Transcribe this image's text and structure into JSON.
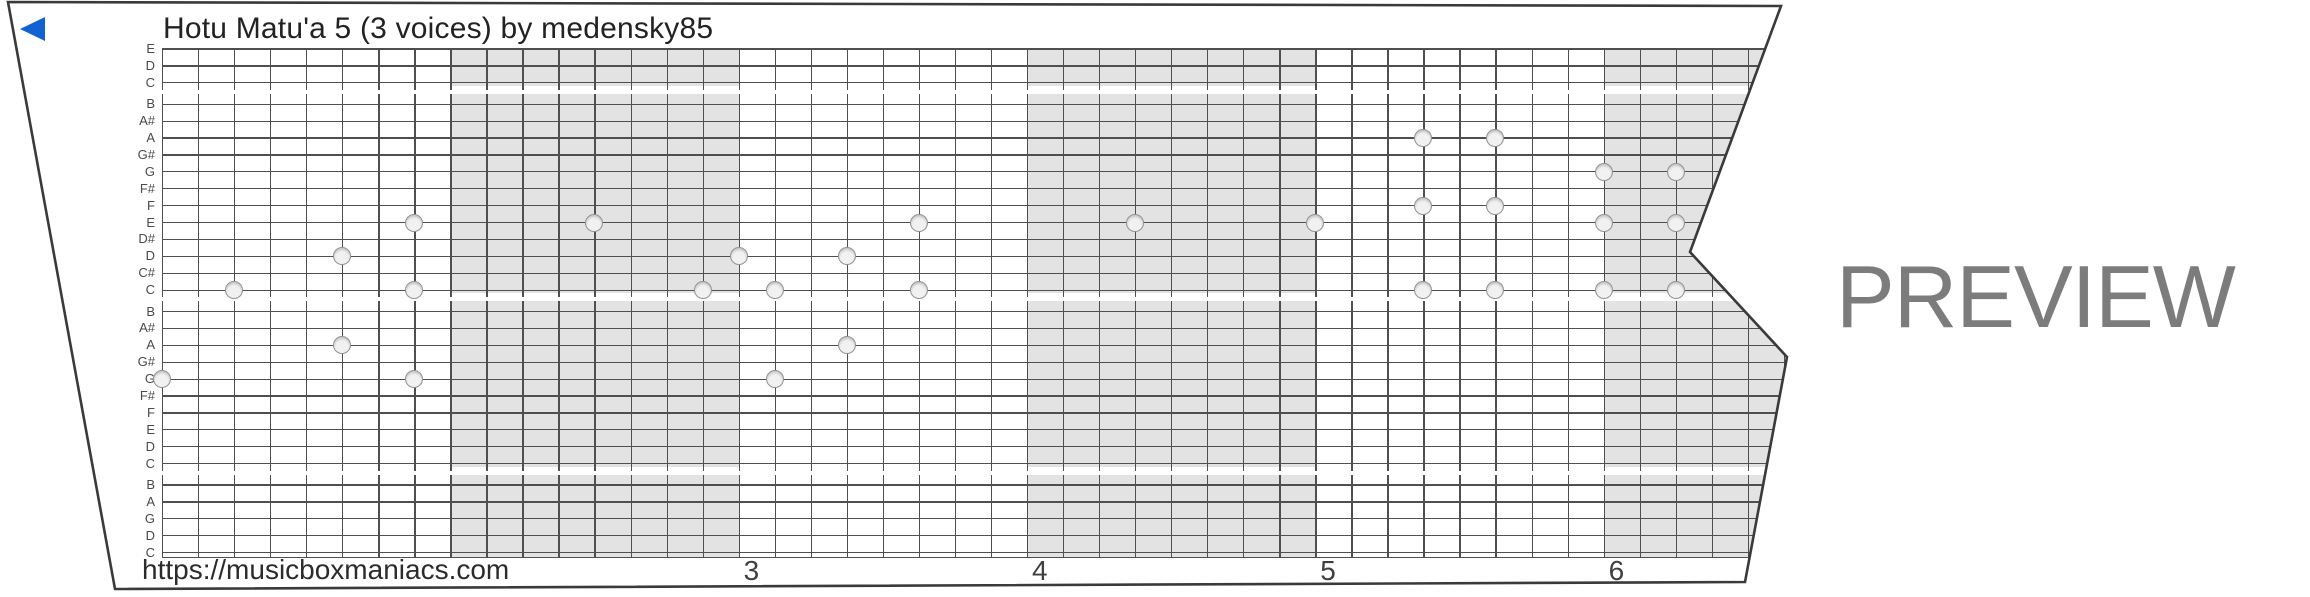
{
  "title": "Hotu Matu'a 5 (3 voices) by medensky85",
  "watermark": "PREVIEW",
  "footer": {
    "url": "https://musicboxmaniacs.com"
  },
  "colors": {
    "play_accent": "#1263d1",
    "paper_edge": "#3a3a3a",
    "grid_line": "#4f4f4f",
    "measure_shade": "#e3e3e3",
    "hole_fill": "#f1f1f1",
    "hole_stroke": "#939393",
    "watermark_gray": "#7c7c7c"
  },
  "strip": {
    "row_labels": [
      "E",
      "D",
      "C",
      "B",
      "A#",
      "A",
      "G#",
      "G",
      "F#",
      "F",
      "E",
      "D#",
      "D",
      "C#",
      "C",
      "B",
      "A#",
      "A",
      "G#",
      "G",
      "F#",
      "F",
      "E",
      "D",
      "C",
      "B",
      "A",
      "G",
      "D",
      "C"
    ],
    "octave_gap_after_rows": [
      3,
      15,
      25
    ],
    "steps_per_measure": 8,
    "visible_steps": 48,
    "measure_numbers": [
      {
        "label": "3",
        "barline_step": 16
      },
      {
        "label": "4",
        "barline_step": 24
      },
      {
        "label": "5",
        "barline_step": 32
      },
      {
        "label": "6",
        "barline_step": 40
      }
    ],
    "shaded_measure_step_ranges": [
      [
        8,
        16
      ],
      [
        24,
        32
      ],
      [
        40,
        48
      ]
    ],
    "notes": [
      {
        "pitch": "G4",
        "row": 20,
        "step": 0
      },
      {
        "pitch": "C5",
        "row": 15,
        "step": 2
      },
      {
        "pitch": "D5",
        "row": 13,
        "step": 5
      },
      {
        "pitch": "A4",
        "row": 18,
        "step": 5
      },
      {
        "pitch": "E5",
        "row": 11,
        "step": 7
      },
      {
        "pitch": "C5",
        "row": 15,
        "step": 7
      },
      {
        "pitch": "G4",
        "row": 20,
        "step": 7
      },
      {
        "pitch": "E5",
        "row": 11,
        "step": 12
      },
      {
        "pitch": "C5",
        "row": 15,
        "step": 15
      },
      {
        "pitch": "D5",
        "row": 13,
        "step": 16
      },
      {
        "pitch": "C5",
        "row": 15,
        "step": 17
      },
      {
        "pitch": "G4",
        "row": 20,
        "step": 17
      },
      {
        "pitch": "D5",
        "row": 13,
        "step": 19
      },
      {
        "pitch": "A4",
        "row": 18,
        "step": 19
      },
      {
        "pitch": "E5",
        "row": 11,
        "step": 21
      },
      {
        "pitch": "C5",
        "row": 15,
        "step": 21
      },
      {
        "pitch": "E5",
        "row": 11,
        "step": 27
      },
      {
        "pitch": "E5",
        "row": 11,
        "step": 32
      },
      {
        "pitch": "A5",
        "row": 6,
        "step": 35
      },
      {
        "pitch": "F5",
        "row": 10,
        "step": 35
      },
      {
        "pitch": "C5",
        "row": 15,
        "step": 35
      },
      {
        "pitch": "A5",
        "row": 6,
        "step": 37
      },
      {
        "pitch": "F5",
        "row": 10,
        "step": 37
      },
      {
        "pitch": "C5",
        "row": 15,
        "step": 37
      },
      {
        "pitch": "G5",
        "row": 8,
        "step": 40
      },
      {
        "pitch": "E5",
        "row": 11,
        "step": 40
      },
      {
        "pitch": "C5",
        "row": 15,
        "step": 40
      },
      {
        "pitch": "G5",
        "row": 8,
        "step": 42
      },
      {
        "pitch": "E5",
        "row": 11,
        "step": 42
      },
      {
        "pitch": "C5",
        "row": 15,
        "step": 42
      }
    ]
  }
}
